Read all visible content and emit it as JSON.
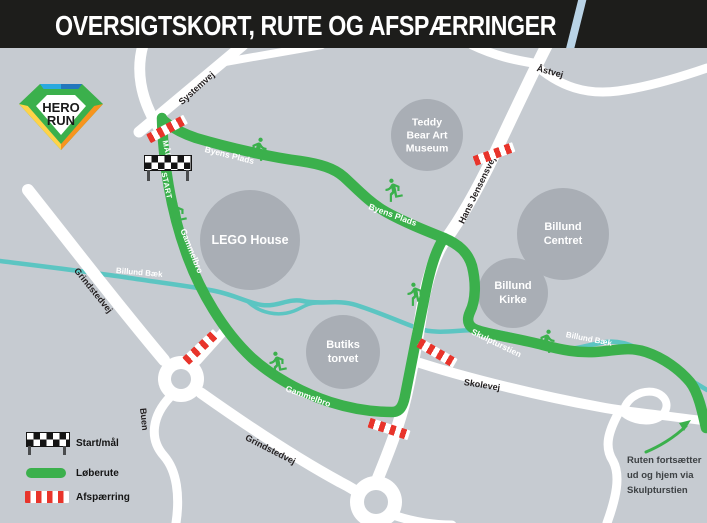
{
  "header": {
    "title": "OVERSIGTSKORT, RUTE OG AFSPÆRRINGER"
  },
  "logo": {
    "line1": "HERO",
    "line2": "RUN"
  },
  "colors": {
    "bg": "#c6cbd1",
    "circle": "#a9aeb5",
    "road": "#ffffff",
    "green": "#3bb04c",
    "red": "#e8342b",
    "stream": "#5cc5c2",
    "header_bg": "#1d1d1b",
    "blue_road": "#b9d3e6",
    "ink": "#231f20",
    "note_ink": "#3d4144"
  },
  "roads": {
    "systemvej": "Systemvej",
    "aastvej": "Åstvej",
    "hans_jensensvej": "Hans Jensensvej",
    "grindstedvej": "Grindstedvej",
    "skolevej": "Skolevej",
    "buen": "Buen"
  },
  "route_labels": {
    "maal": "MÅL",
    "start": "START",
    "byens_plads": "Byens Plads",
    "gammelbro": "Gammelbro",
    "skulpturstien": "Skulpturstien"
  },
  "stream": {
    "label": "Billund Bæk"
  },
  "places": {
    "lego_house": "LEGO House",
    "teddy_museum": "Teddy\nBear Art\nMuseum",
    "billund_centret": "Billund\nCentret",
    "billund_kirke": "Billund\nKirke",
    "butikstorvet": "Butiks\ntorvet"
  },
  "legend": {
    "items": [
      {
        "label": "Start/mål"
      },
      {
        "label": "Løberute"
      },
      {
        "label": "Afspærring"
      }
    ]
  },
  "note": {
    "text": "Ruten fortsætter\nud og hjem via\nSkulpturstien"
  }
}
